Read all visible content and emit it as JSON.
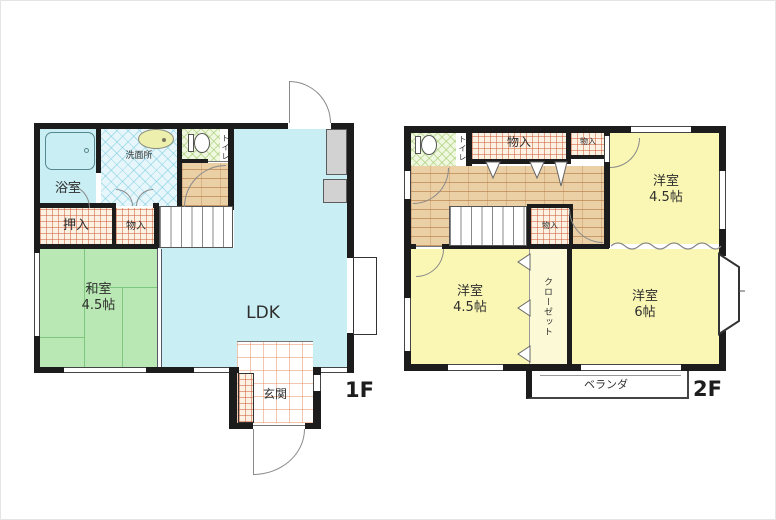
{
  "plan": {
    "type": "floor-plan",
    "floors": {
      "f1": {
        "name": "1F",
        "rooms": {
          "bath": "浴室",
          "wash": "洗面所",
          "toilet": "トイレ",
          "oshiire": "押入",
          "mono": "物入",
          "washitsu": "和室",
          "washitsu_size": "4.5帖",
          "ldk": "LDK",
          "genkan": "玄関"
        }
      },
      "f2": {
        "name": "2F",
        "rooms": {
          "toilet": "トイレ",
          "mono_large": "物入",
          "mono_small": "物入",
          "mono_mid": "物入",
          "west_ne": "洋室",
          "west_ne_size": "4.5帖",
          "west_sw": "洋室",
          "west_sw_size": "4.5帖",
          "west_se": "洋室",
          "west_se_size": "6帖",
          "closet": "クローゼット",
          "veranda": "ベランダ"
        }
      }
    },
    "colors": {
      "wall": "#1c1c1c",
      "water_blue": "#c9eef3",
      "tatami_green": "#b9e8b4",
      "room_yellow": "#faf7b4",
      "closet_yellow": "#fcfad6",
      "wood_floor": "#ebcfa5",
      "fixture_gray": "#d2d2d2"
    }
  }
}
